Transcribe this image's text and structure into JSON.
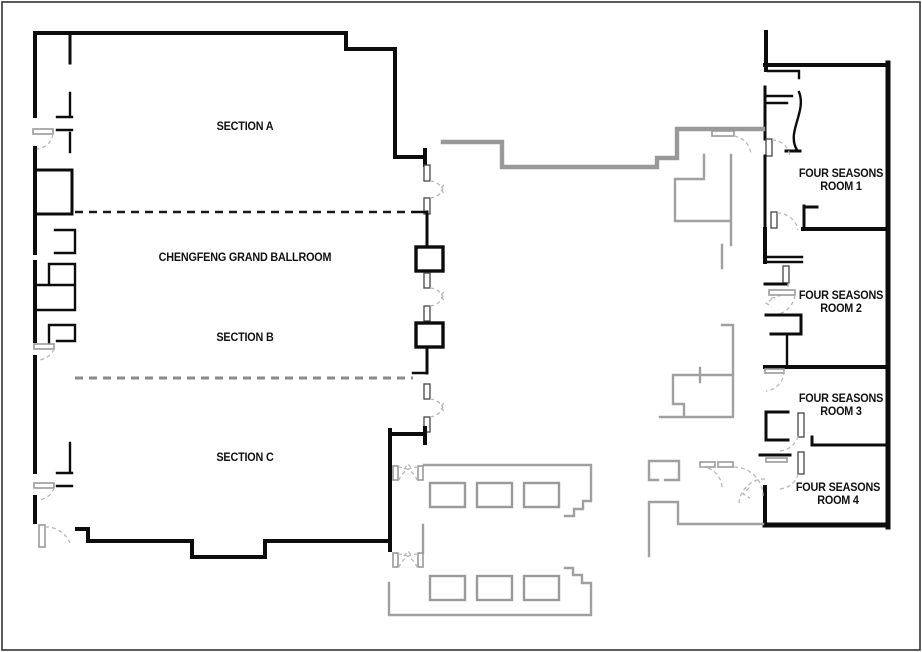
{
  "floor_plan": {
    "ballroom": {
      "section_a": "SECTION A",
      "name": "CHENGFENG GRAND BALLROOM",
      "section_b": "SECTION B",
      "section_c": "SECTION C"
    },
    "four_seasons_rooms": [
      {
        "line1": "FOUR SEASONS",
        "line2": "ROOM 1"
      },
      {
        "line1": "FOUR SEASONS",
        "line2": "ROOM 2"
      },
      {
        "line1": "FOUR SEASONS",
        "line2": "ROOM 3"
      },
      {
        "line1": "FOUR SEASONS",
        "line2": "ROOM 4"
      }
    ],
    "colors": {
      "wall": "#0c0c0c",
      "corridor_wall": "#999999",
      "door_swing": "#b8b8b8",
      "background": "#ffffff"
    }
  }
}
